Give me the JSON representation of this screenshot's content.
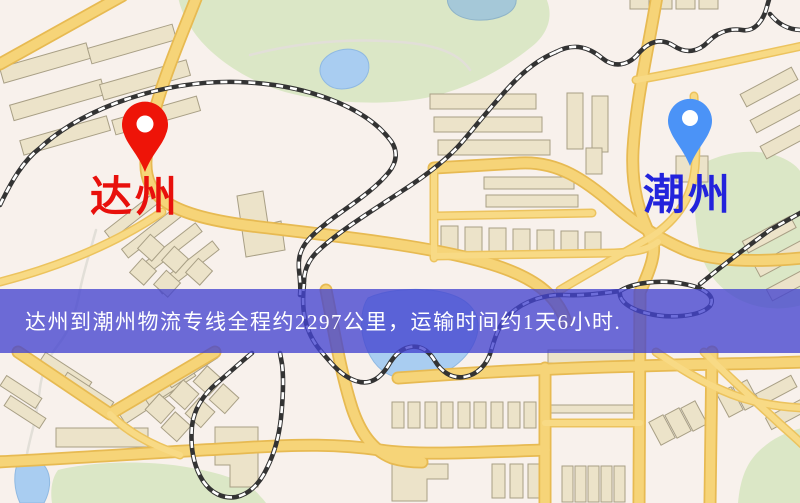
{
  "banner": {
    "text": "达州到潮州物流专线全程约2297公里，运输时间约1天6小时.",
    "background_color": "#4444cf",
    "background_opacity": 0.78,
    "text_color": "#ffffff"
  },
  "markers": {
    "origin": {
      "label": "达州",
      "pin_color": "#ee1408",
      "label_color": "#e8100c"
    },
    "destination": {
      "label": "潮州",
      "pin_color": "#4b93f7",
      "label_color": "#2323dc"
    }
  },
  "route": {
    "origin": "达州",
    "destination": "潮州",
    "distance_km": "2297",
    "duration": "1天6小时"
  },
  "map_colors": {
    "background": "#f8f1ec",
    "road": "#f6d478",
    "park": "#dbe7c6",
    "water": "#a9cdf1",
    "building": "#ece3c9",
    "railway": "#333333"
  }
}
